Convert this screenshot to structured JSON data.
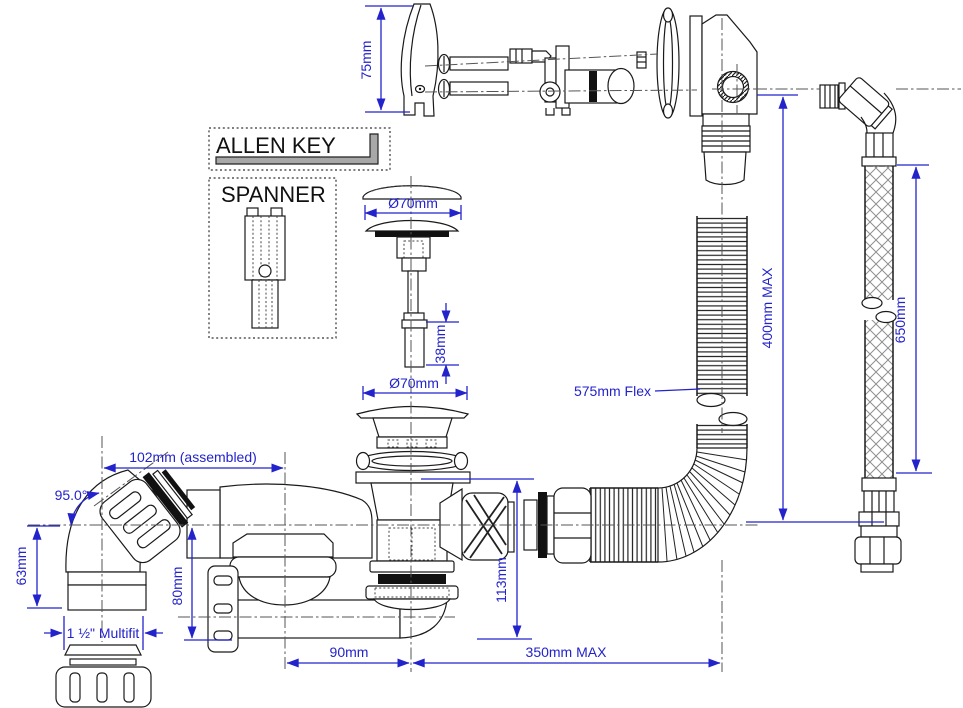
{
  "diagram": {
    "type": "technical-exploded-diagram",
    "subject": "Bath waste, overflow and flexible connector installation diagram",
    "colors": {
      "dimension_blue": "#2323cc",
      "linework_black": "#1a1a1a",
      "background": "#ffffff",
      "tool_gray": "#a8a8a8"
    },
    "tools": {
      "allen_key": "ALLEN KEY",
      "spanner": "SPANNER"
    },
    "dimensions": {
      "overflow_plate_height": "75mm",
      "plug_cap_diameter": "Ø70mm",
      "grub_screw_length": "38mm",
      "waste_flange_diameter": "Ø70mm",
      "flex_pipe_label": "575mm Flex",
      "overflow_drop_max": "400mm MAX",
      "hose_length": "650mm",
      "elbow_assembled_width": "102mm (assembled)",
      "elbow_angle": "95.0°",
      "elbow_height": "63mm",
      "elbow_thread": "1 ½\" Multifit",
      "trap_inlet_height": "80mm",
      "waste_body_height": "113mm",
      "trap_horizontal_offset": "90mm",
      "outlet_reach_max": "350mm MAX"
    }
  }
}
